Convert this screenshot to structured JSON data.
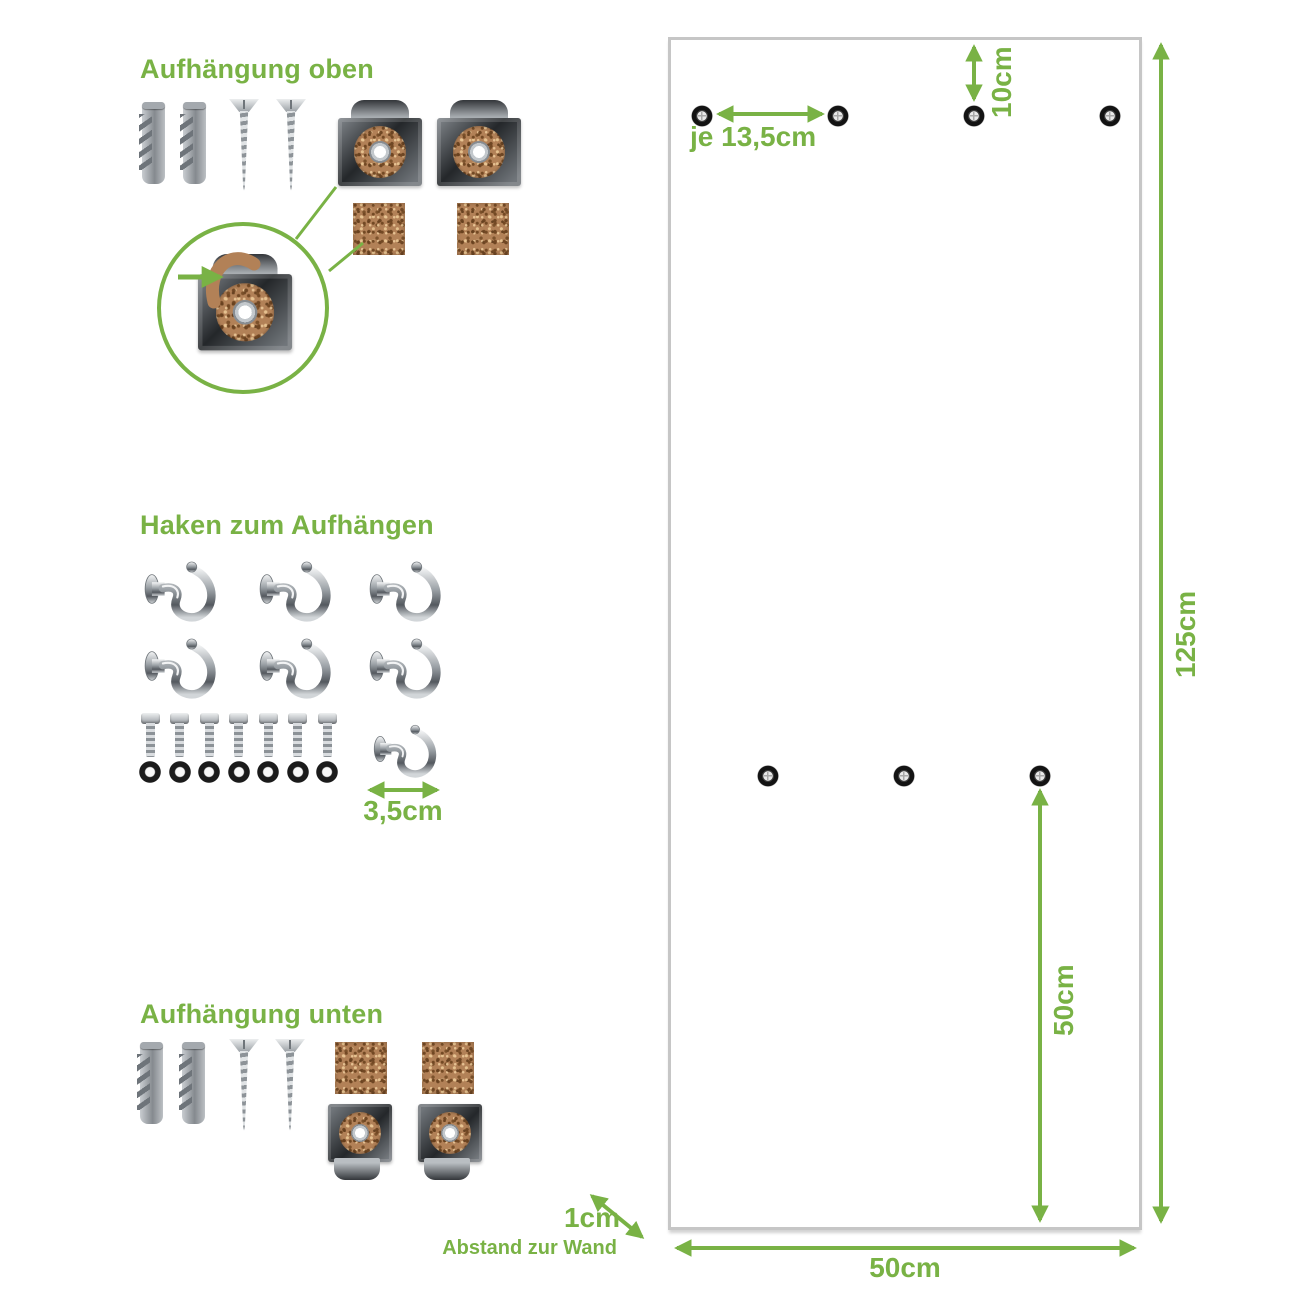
{
  "colors": {
    "green": "#79b245",
    "panel_border": "#c6c6c6",
    "cork": "#b28157"
  },
  "sections": {
    "top": {
      "title": "Aufhängung oben",
      "items": [
        "wall-plug",
        "wall-plug",
        "screw",
        "screw",
        "mounting-clip",
        "mounting-clip",
        "cork-pad",
        "cork-pad"
      ],
      "detail": "clip-with-cork-strip-magnified"
    },
    "hooks": {
      "title": "Haken zum Aufhängen",
      "hook_count": 7,
      "bolt_count": 7,
      "washer_count": 7,
      "dim_hook_size": "3,5cm"
    },
    "bottom": {
      "title": "Aufhängung unten",
      "items": [
        "wall-plug",
        "wall-plug",
        "screw",
        "screw",
        "cork-pad",
        "cork-pad",
        "mounting-clip",
        "mounting-clip"
      ]
    }
  },
  "panel": {
    "top_hole_count": 4,
    "middle_hole_count": 3,
    "dim_top_offset": "10cm",
    "dim_hole_spacing": "je 13,5cm",
    "dim_height": "125cm",
    "dim_mid_to_bottom": "50cm",
    "dim_width": "50cm",
    "dim_wall_gap": "1cm",
    "wall_gap_caption": "Abstand zur Wand"
  }
}
